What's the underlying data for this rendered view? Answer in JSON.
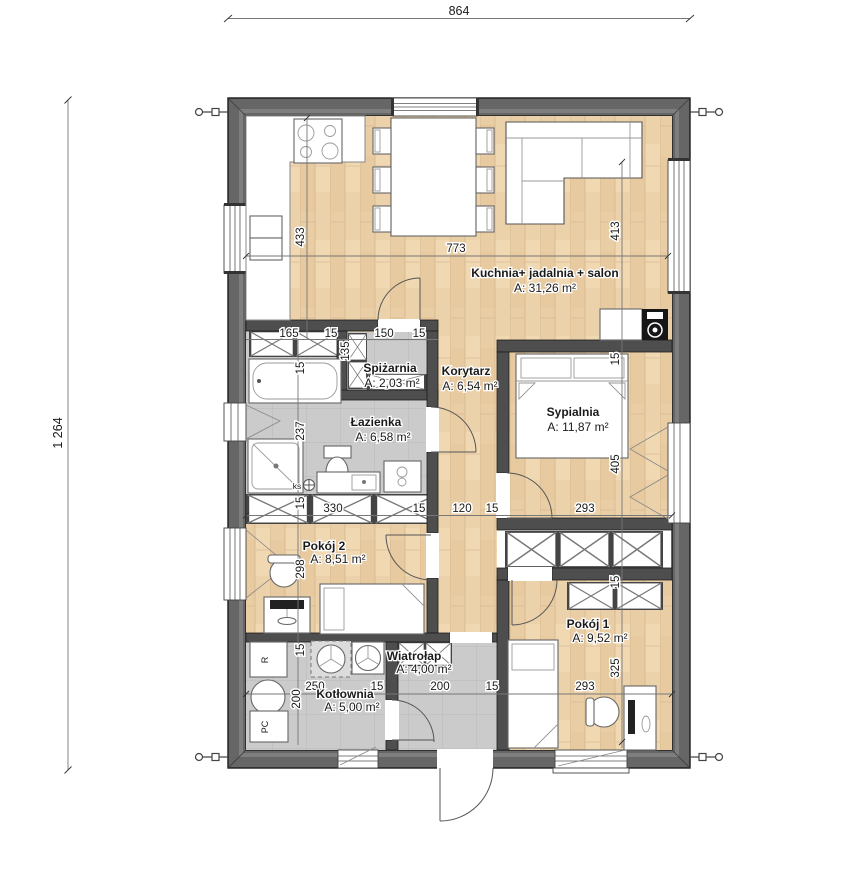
{
  "plan": {
    "title": "single-storey house floor plan",
    "overall": {
      "width_label": "864",
      "height_label": "1 264"
    },
    "rooms": [
      {
        "name": "Kuchnia+ jadalnia + salon",
        "area": "A: 31,26 m²"
      },
      {
        "name": "Spiżarnia",
        "area": "A: 2,03 m²"
      },
      {
        "name": "Korytarz",
        "area": "A: 6,54 m²"
      },
      {
        "name": "Łazienka",
        "area": "A: 6,58 m²"
      },
      {
        "name": "Sypialnia",
        "area": "A: 11,87 m²"
      },
      {
        "name": "Pokój 2",
        "area": "A: 8,51 m²"
      },
      {
        "name": "Pokój 1",
        "area": "A: 9,52 m²"
      },
      {
        "name": "Wiatrołap",
        "area": "A: 4,00 m²"
      },
      {
        "name": "Kotłownia",
        "area": "A: 5,00 m²"
      }
    ],
    "dims": {
      "building_width": "864",
      "building_height": "1 264",
      "k433": "433",
      "k773": "773",
      "k413": "413",
      "r1a": "165",
      "r1b": "15",
      "r1c": "150",
      "r1d": "15",
      "p135": "135",
      "b15": "15",
      "b237": "237",
      "m15a": "15",
      "m330": "330",
      "m15b": "15",
      "m120": "120",
      "m15c": "15",
      "m293": "293",
      "p298": "298",
      "s15": "15",
      "s405": "405",
      "q15": "15",
      "q325": "325",
      "c15": "15",
      "c250": "250",
      "c15b": "15",
      "c200v": "200",
      "w200": "200",
      "w15": "15",
      "w293": "293",
      "ks": "ks",
      "r_label": "R",
      "pc_label": "PC"
    },
    "colors": {
      "exterior_wall": "#666666",
      "interior_wall": "#4e4e4e",
      "wood_floor": "#ecd2ab",
      "tile_floor": "#cbcbcb",
      "line": "#1a1a1a"
    }
  }
}
